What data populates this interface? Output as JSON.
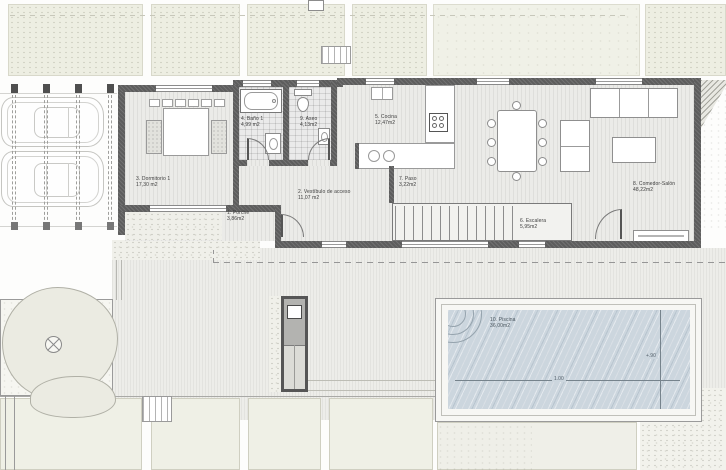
{
  "colors": {
    "wall": "#5d5d5d",
    "pool_water": "#ccd6de",
    "garden_panel": "#edeee2",
    "floor": "#ebebe8",
    "label_text": "#3c3c3c"
  },
  "rooms": {
    "porche": {
      "label": "1. Porche",
      "area": "3,86m2"
    },
    "vestibulo": {
      "label": "2. Vestíbulo de acceso",
      "area": "11,07 m2"
    },
    "dormitorio": {
      "label": "3. Dormitorio 1",
      "area": "17,30 m2"
    },
    "bano": {
      "label": "4. Baño 1",
      "area": "4,99 m2"
    },
    "cocina": {
      "label": "5. Cocina",
      "area": "12,47m2"
    },
    "escalera": {
      "label": "6. Escalera",
      "area": "5,95m2"
    },
    "paso": {
      "label": "7. Paso",
      "area": "3,22m2"
    },
    "comedor": {
      "label": "8. Comedor-Salón",
      "area": "48,22m2"
    },
    "aseo": {
      "label": "9. Aseo",
      "area": "4,13m2"
    },
    "piscina": {
      "label": "10. Piscina",
      "area": "36,00m2"
    }
  },
  "pool": {
    "dim_length": "1.00",
    "dim_depth": "+.90"
  }
}
